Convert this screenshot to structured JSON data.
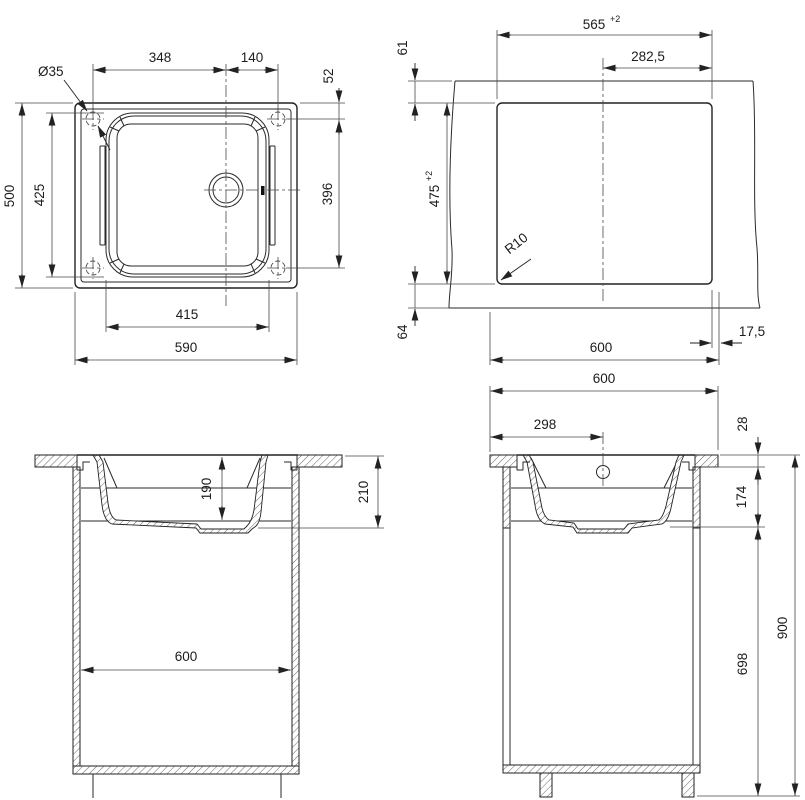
{
  "drawing": {
    "top_view": {
      "hole_diameter": "Ø35",
      "hole_to_drain": "348",
      "drain_to_hole": "140",
      "edge_to_hole": "52",
      "overall_depth": "500",
      "bowl_depth": "425",
      "hole_to_hole": "396",
      "bowl_width": "415",
      "overall_width": "590"
    },
    "cutout_view": {
      "cutout_width": "565",
      "cutout_width_tol": "+2",
      "center_to_edge": "282,5",
      "top_offset": "61",
      "cutout_depth": "475",
      "cutout_depth_tol": "+2",
      "corner_radius": "R10",
      "bottom_offset": "64",
      "cabinet_width": "600",
      "side_clearance": "17,5"
    },
    "front_section": {
      "bowl_inner_depth": "190",
      "total_depth": "210",
      "cabinet_width": "600"
    },
    "side_section": {
      "counter_depth": "600",
      "edge_to_drain": "298",
      "counter_thickness": "28",
      "under_counter": "174",
      "overall_height": "900",
      "cabinet_height": "698"
    }
  }
}
